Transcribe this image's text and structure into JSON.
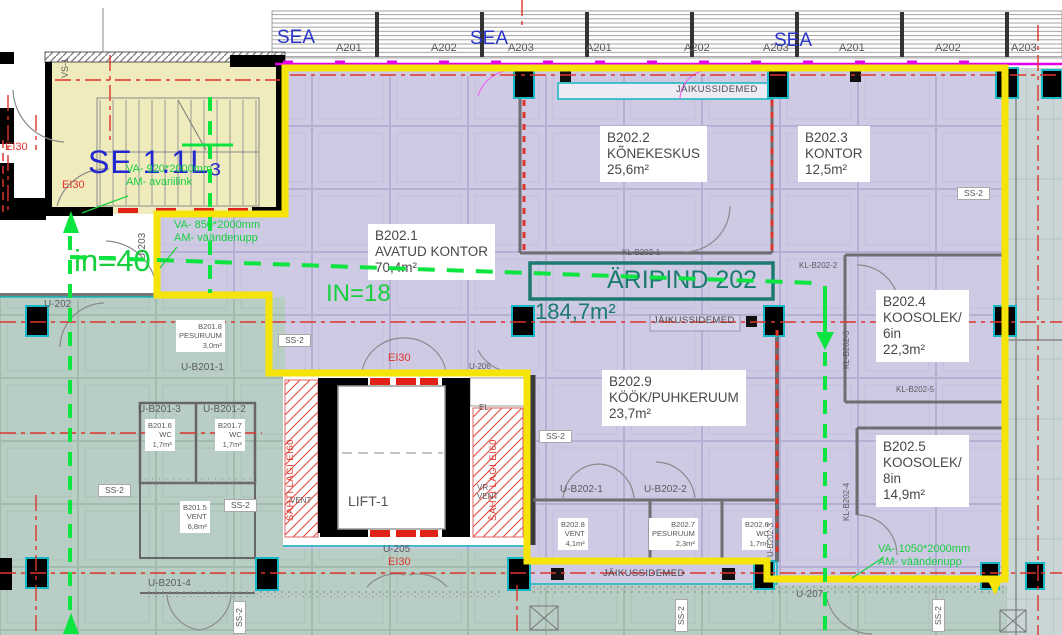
{
  "title": "Floor plan — ÄRIPIND 202 (184,7m²)",
  "colors": {
    "boundary_yellow": "#f6e409",
    "retail_fill": "#cecae4",
    "common_fill": "#b8cec4",
    "stair_fill": "#f0ebbd",
    "right_band_fill": "#c9d6d5",
    "escape_green": "#17cf3e",
    "axis_red": "#dd352b",
    "curtainwall_magenta": "#e402e4",
    "tenant_teal": "#1d7a6f",
    "label_blue": "#2a35c8"
  },
  "tenant": {
    "label": "ÄRIPIND 202",
    "area": "184,7m²"
  },
  "rooms": [
    {
      "number": "B202.1",
      "name": "AVATUD KONTOR",
      "area": "70,4m²"
    },
    {
      "number": "B202.2",
      "name": "KÕNEKESKUS",
      "area": "25,6m²"
    },
    {
      "number": "B202.3",
      "name": "KONTOR",
      "area": "12,5m²"
    },
    {
      "number": "B202.4",
      "name": "KOOSOLEK/6in",
      "area": "22,3m²"
    },
    {
      "number": "B202.5",
      "name": "KOOSOLEK/8in",
      "area": "14,9m²"
    },
    {
      "number": "B202.9",
      "name": "KÖÖK/PUHKERUUM",
      "area": "23,7m²"
    },
    {
      "number": "B201.5",
      "name": "VENT",
      "area": "6,8m²"
    },
    {
      "number": "B201.6",
      "name": "WC",
      "area": "1,7m²"
    },
    {
      "number": "B201.7",
      "name": "WC",
      "area": "1,7m²"
    },
    {
      "number": "B201.8",
      "name": "PESURUUM",
      "area": "3,0m²"
    },
    {
      "number": "B202.6",
      "name": "WC",
      "area": "1,7m²"
    },
    {
      "number": "B202.7",
      "name": "PESURUUM",
      "area": "2,3m²"
    },
    {
      "number": "B202.8",
      "name": "VENT",
      "area": "4,1m²"
    }
  ],
  "labels": [
    {
      "n": "axis-a201-1",
      "c": "axis",
      "x": 336,
      "y": 42,
      "t": "A201"
    },
    {
      "n": "axis-a202-1",
      "c": "axis",
      "x": 431,
      "y": 42,
      "t": "A202"
    },
    {
      "n": "axis-a203-1",
      "c": "axis",
      "x": 508,
      "y": 42,
      "t": "A203"
    },
    {
      "n": "axis-a201-2",
      "c": "axis",
      "x": 586,
      "y": 42,
      "t": "A201"
    },
    {
      "n": "axis-a202-2",
      "c": "axis",
      "x": 684,
      "y": 42,
      "t": "A202"
    },
    {
      "n": "axis-a203-2",
      "c": "axis",
      "x": 763,
      "y": 42,
      "t": "A203"
    },
    {
      "n": "axis-a201-3",
      "c": "axis",
      "x": 839,
      "y": 42,
      "t": "A201"
    },
    {
      "n": "axis-a202-3",
      "c": "axis",
      "x": 935,
      "y": 42,
      "t": "A202"
    },
    {
      "n": "axis-a203-3",
      "c": "axis",
      "x": 1011,
      "y": 42,
      "t": "A203"
    },
    {
      "n": "sea-label-1",
      "c": "sea",
      "x": 277,
      "y": 27,
      "t": "SEA"
    },
    {
      "n": "sea-label-2",
      "c": "sea",
      "x": 470,
      "y": 28,
      "t": "SEA"
    },
    {
      "n": "sea-label-3",
      "c": "sea",
      "x": 774,
      "y": 30,
      "t": "SEA"
    },
    {
      "n": "vs-1-label",
      "c": "axis-sm rot",
      "x": 60,
      "y": 78,
      "t": "VS-1"
    },
    {
      "n": "stair-id",
      "c": "blue-big",
      "x": 88,
      "y": 144,
      "t": "SE 1.1L₃"
    },
    {
      "n": "stair-exit-note",
      "c": "green-note",
      "x": 126,
      "y": 163,
      "t": [
        "VA- 920*2000mm",
        "AM- avariilink"
      ]
    },
    {
      "n": "ei30-door-left",
      "c": "red",
      "x": 5,
      "y": 141,
      "t": "EI30"
    },
    {
      "n": "ei30-stair-door",
      "c": "red",
      "x": 62,
      "y": 179,
      "t": "EI30"
    },
    {
      "n": "occupancy-in40",
      "c": "green-huge",
      "x": 74,
      "y": 243,
      "t": "in=40"
    },
    {
      "n": "u-203-label",
      "c": "u-med rot",
      "x": 137,
      "y": 260,
      "t": "U-203"
    },
    {
      "n": "door-note-850",
      "c": "green-note",
      "x": 174,
      "y": 219,
      "t": [
        "VA- 850*2000mm",
        "AM- väändenupp"
      ]
    },
    {
      "n": "occupancy-in18",
      "c": "green-big",
      "x": 326,
      "y": 280,
      "t": "IN=18"
    },
    {
      "n": "room-b202-1",
      "c": "room-lg",
      "x": 368,
      "y": 224,
      "t": [
        "B202.1",
        "AVATUD KONTOR",
        "70,4m²"
      ]
    },
    {
      "n": "room-b202-2",
      "c": "room-lg",
      "x": 600,
      "y": 126,
      "t": [
        "B202.2",
        "KÕNEKESKUS",
        "25,6m²"
      ]
    },
    {
      "n": "room-b202-3",
      "c": "room-lg",
      "x": 798,
      "y": 126,
      "t": [
        "B202.3",
        "KONTOR",
        "12,5m²"
      ]
    },
    {
      "n": "aripind-title",
      "c": "teal-big",
      "x": 607,
      "y": 266,
      "t": "ÄRIPIND 202"
    },
    {
      "n": "aripind-area",
      "c": "teal-med",
      "x": 535,
      "y": 299,
      "t": "184,7m²"
    },
    {
      "n": "kl-b202-1",
      "c": "kl",
      "x": 622,
      "y": 248,
      "t": "KL-B202-1"
    },
    {
      "n": "kl-b202-2",
      "c": "kl",
      "x": 799,
      "y": 261,
      "t": "KL-B202-2"
    },
    {
      "n": "kl-b202-3",
      "c": "kl rot",
      "x": 842,
      "y": 369,
      "t": "KL-B202-3"
    },
    {
      "n": "kl-b202-5",
      "c": "kl",
      "x": 896,
      "y": 385,
      "t": "KL-B202-5"
    },
    {
      "n": "kl-b202-4",
      "c": "kl rot",
      "x": 842,
      "y": 521,
      "t": "KL-B202-4"
    },
    {
      "n": "room-b202-4",
      "c": "room-lg",
      "x": 876,
      "y": 290,
      "t": [
        "B202.4",
        "KOOSOLEK/",
        "6in",
        "22,3m²"
      ]
    },
    {
      "n": "room-b202-5",
      "c": "room-lg",
      "x": 876,
      "y": 435,
      "t": [
        "B202.5",
        "KOOSOLEK/",
        "8in",
        "14,9m²"
      ]
    },
    {
      "n": "room-b202-9",
      "c": "room-lg",
      "x": 602,
      "y": 370,
      "t": [
        "B202.9",
        "KÖÖK/PUHKERUUM",
        "23,7m²"
      ]
    },
    {
      "n": "jaikussidemed-top",
      "c": "jk",
      "x": 676,
      "y": 84,
      "t": "JÄIKUSSIDEMED"
    },
    {
      "n": "jaikussidemed-mid",
      "c": "jk",
      "x": 653,
      "y": 315,
      "t": "JÄIKUSSIDEMED"
    },
    {
      "n": "jaikussidemed-bottom",
      "c": "jk",
      "x": 603,
      "y": 568,
      "t": "JÄIKUSSIDEMED"
    },
    {
      "n": "ss2-1",
      "c": "ss2",
      "x": 278,
      "y": 334,
      "t": "SS-2"
    },
    {
      "n": "ss2-2",
      "c": "ss2",
      "x": 957,
      "y": 187,
      "t": "SS-2"
    },
    {
      "n": "ss2-3",
      "c": "ss2",
      "x": 539,
      "y": 430,
      "t": "SS-2"
    },
    {
      "n": "ss2-4",
      "c": "ss2",
      "x": 98,
      "y": 484,
      "t": "SS-2"
    },
    {
      "n": "ss2-5",
      "c": "ss2",
      "x": 224,
      "y": 499,
      "t": "SS-2"
    },
    {
      "n": "ss2-6",
      "c": "ss2 rot",
      "x": 233,
      "y": 634,
      "t": "SS-2"
    },
    {
      "n": "ss2-7",
      "c": "ss2 rot",
      "x": 675,
      "y": 632,
      "t": "SS-2"
    },
    {
      "n": "ss2-8",
      "c": "ss2 rot",
      "x": 932,
      "y": 632,
      "t": "SS-2"
    },
    {
      "n": "room-b201-8",
      "c": "room-sm",
      "x": 176,
      "y": 320,
      "t": [
        "B201.8",
        "PESURUUM",
        "3,0m²"
      ]
    },
    {
      "n": "u-b201-1",
      "c": "u-med",
      "x": 181,
      "y": 362,
      "t": "U-B201-1"
    },
    {
      "n": "u-b201-3",
      "c": "u-med",
      "x": 138,
      "y": 404,
      "t": "U-B201-3"
    },
    {
      "n": "u-b201-2",
      "c": "u-med",
      "x": 203,
      "y": 404,
      "t": "U-B201-2"
    },
    {
      "n": "room-b201-6",
      "c": "room-sm",
      "x": 145,
      "y": 419,
      "t": [
        "B201.6",
        "WC",
        "1,7m²"
      ]
    },
    {
      "n": "room-b201-7",
      "c": "room-sm",
      "x": 215,
      "y": 419,
      "t": [
        "B201.7",
        "WC",
        "1,7m²"
      ]
    },
    {
      "n": "room-b201-5",
      "c": "room-sm",
      "x": 180,
      "y": 501,
      "t": [
        "B201.5",
        "VENT",
        "6,8m²"
      ]
    },
    {
      "n": "u-b201-4",
      "c": "u-med",
      "x": 148,
      "y": 578,
      "t": "U-B201-4"
    },
    {
      "n": "saht-lagi-left",
      "c": "red-vert rot",
      "x": 285,
      "y": 521,
      "t": "ŠAHTI LAGI EI60"
    },
    {
      "n": "vent-left-shaft",
      "c": "u-sm",
      "x": 290,
      "y": 496,
      "t": "VENT"
    },
    {
      "n": "lift-1-label",
      "c": "lift",
      "x": 348,
      "y": 493,
      "t": "LIFT-1"
    },
    {
      "n": "el-label",
      "c": "u-sm",
      "x": 479,
      "y": 403,
      "t": "EL"
    },
    {
      "n": "saht-lagi-right",
      "c": "red-vert rot",
      "x": 488,
      "y": 521,
      "t": "ŠAHTI LAGI EI60"
    },
    {
      "n": "vr-vent-label",
      "c": "u-sm",
      "x": 477,
      "y": 483,
      "t": [
        "VR",
        "VENT"
      ]
    },
    {
      "n": "ei30-lift-corridor",
      "c": "red",
      "x": 388,
      "y": 352,
      "t": "EI30"
    },
    {
      "n": "u-206-label",
      "c": "u-sm",
      "x": 469,
      "y": 362,
      "t": "U-206"
    },
    {
      "n": "u-202-label",
      "c": "u-med",
      "x": 44,
      "y": 299,
      "t": "U-202"
    },
    {
      "n": "u-205-label",
      "c": "u-med",
      "x": 383,
      "y": 544,
      "t": "U-205"
    },
    {
      "n": "ei30-u205",
      "c": "red",
      "x": 388,
      "y": 556,
      "t": "EI30"
    },
    {
      "n": "u-b202-1",
      "c": "u-med",
      "x": 560,
      "y": 484,
      "t": "U-B202-1"
    },
    {
      "n": "u-b202-2",
      "c": "u-med",
      "x": 644,
      "y": 484,
      "t": "U-B202-2"
    },
    {
      "n": "room-b202-8",
      "c": "room-sm",
      "x": 558,
      "y": 518,
      "t": [
        "B202.8",
        "VENT",
        "4,1m²"
      ]
    },
    {
      "n": "room-b202-7",
      "c": "room-sm",
      "x": 649,
      "y": 518,
      "t": [
        "B202.7",
        "PESURUUM",
        "2,3m²"
      ]
    },
    {
      "n": "room-b202-6",
      "c": "room-sm",
      "x": 742,
      "y": 518,
      "t": [
        "B202.6",
        "WC",
        "1,7m²"
      ]
    },
    {
      "n": "u-b202-3",
      "c": "u-sm rot",
      "x": 766,
      "y": 557,
      "t": "U-B202-3"
    },
    {
      "n": "u-207-label",
      "c": "u-med",
      "x": 796,
      "y": 589,
      "t": "U-207"
    },
    {
      "n": "door-note-1050",
      "c": "green-note",
      "x": 878,
      "y": 543,
      "t": [
        "VA- 1050*2000mm",
        "AM- väändenupp"
      ]
    }
  ]
}
